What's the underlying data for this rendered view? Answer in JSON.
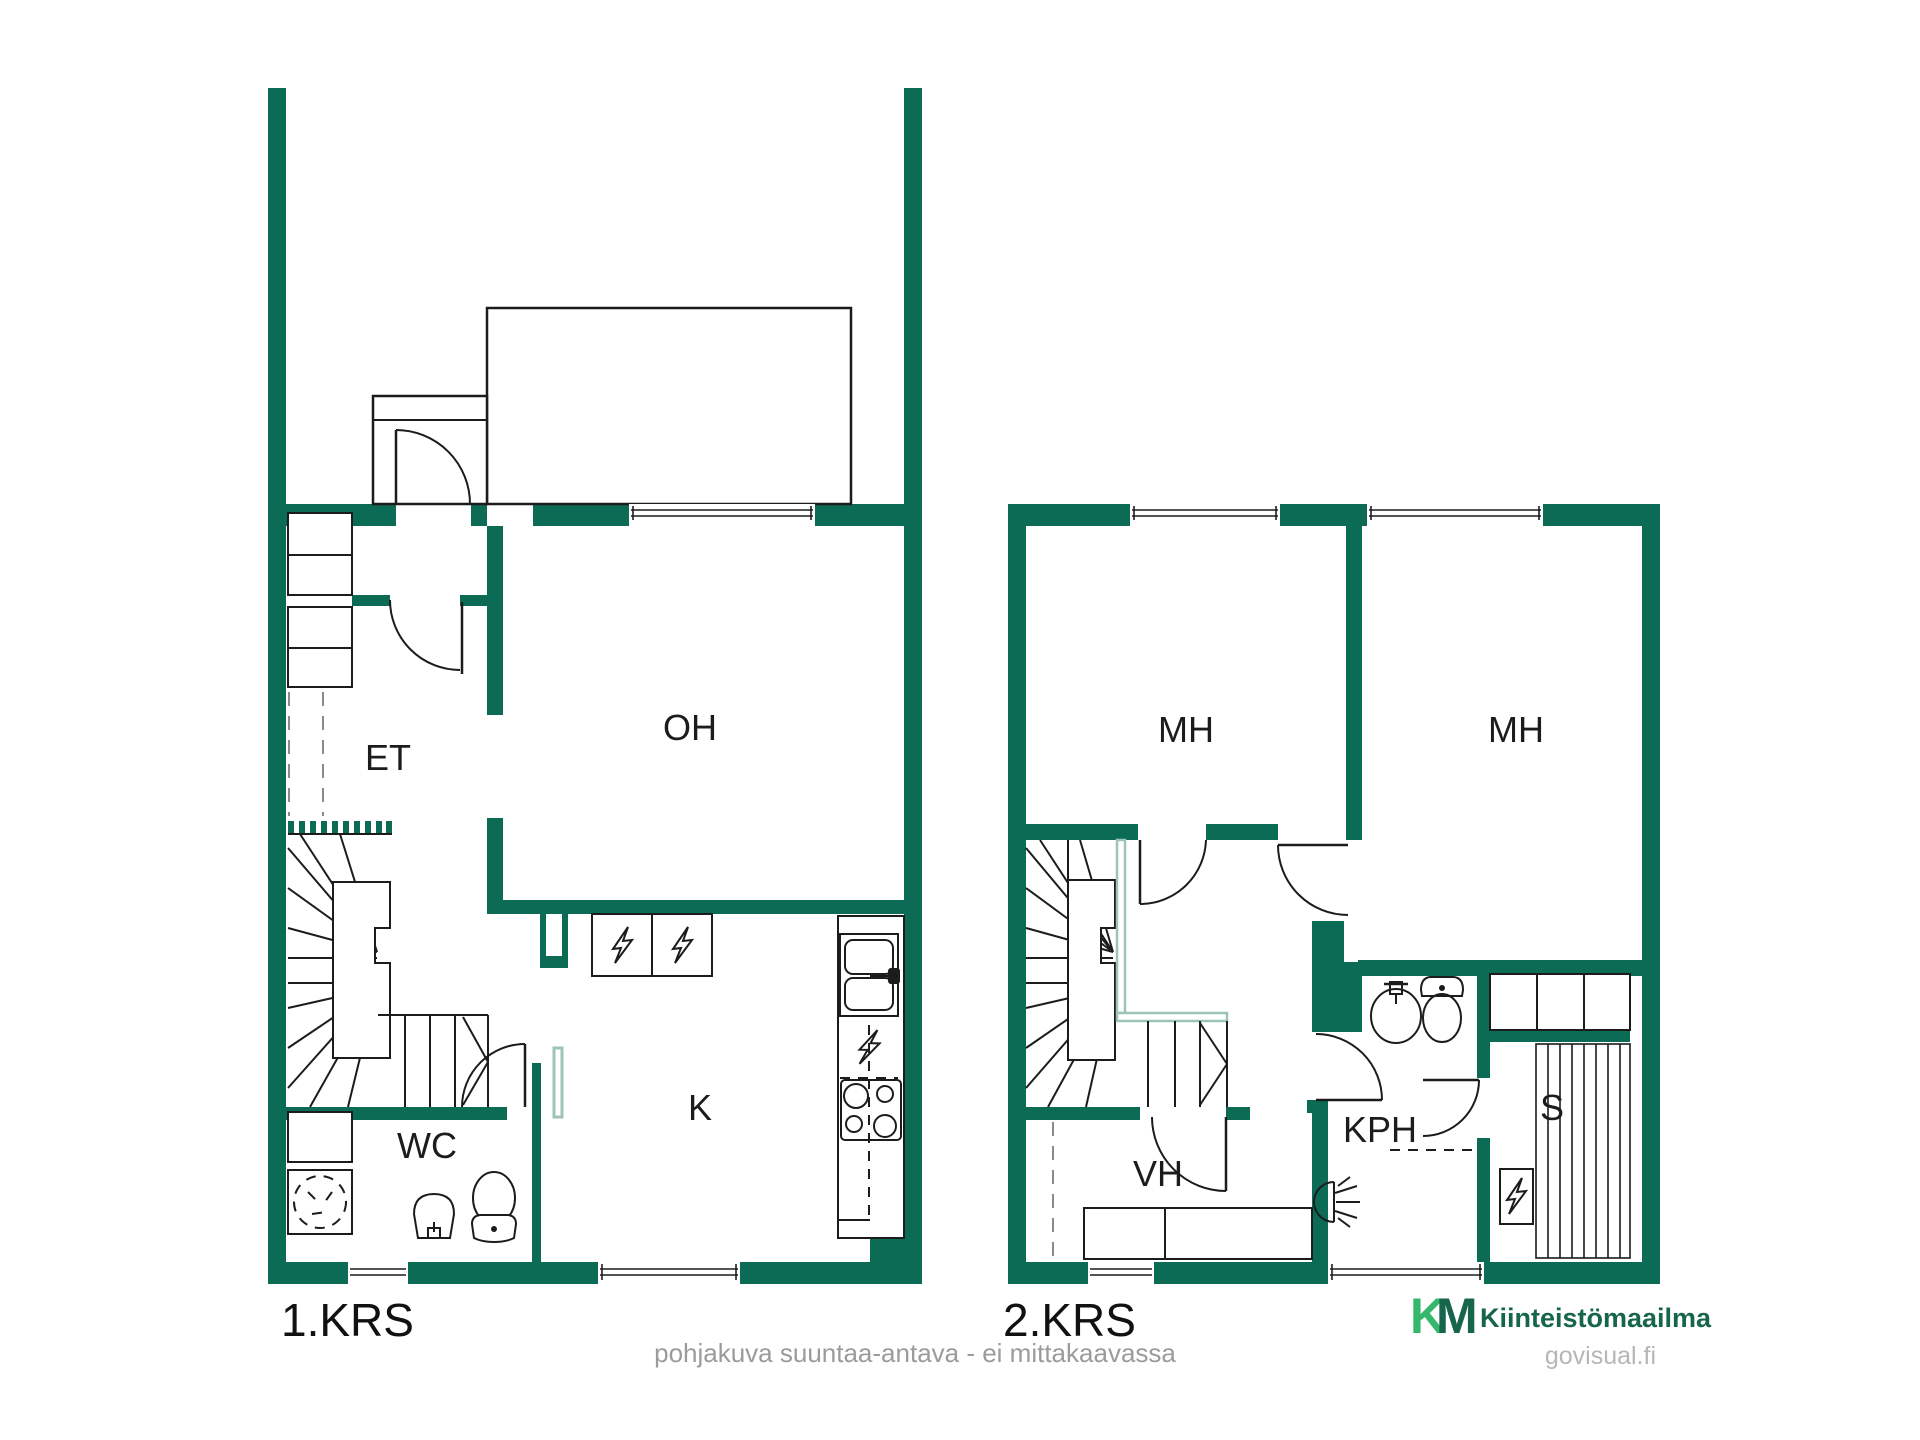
{
  "floor1": {
    "label": "1.KRS",
    "rooms": {
      "et": "ET",
      "oh": "OH",
      "k": "K",
      "wc": "WC"
    }
  },
  "floor2": {
    "label": "2.KRS",
    "rooms": {
      "mh1": "MH",
      "mh2": "MH",
      "vh": "VH",
      "kph": "KPH",
      "s": "S"
    }
  },
  "footer": {
    "disclaimer": "pohjakuva suuntaa-antava - ei mittakaavassa"
  },
  "branding": {
    "logo_k": "K",
    "logo_m": "M",
    "name": "Kiinteistömaailma",
    "watermark": "govisual.fi"
  },
  "colors": {
    "wall": "#0c6b55",
    "rail": "#9cc4b9",
    "logo_light": "#35b86b",
    "logo_dark": "#17654d",
    "muted": "#9b9b9b",
    "watermark": "#b6b6b6",
    "line": "#1c1c1c"
  }
}
